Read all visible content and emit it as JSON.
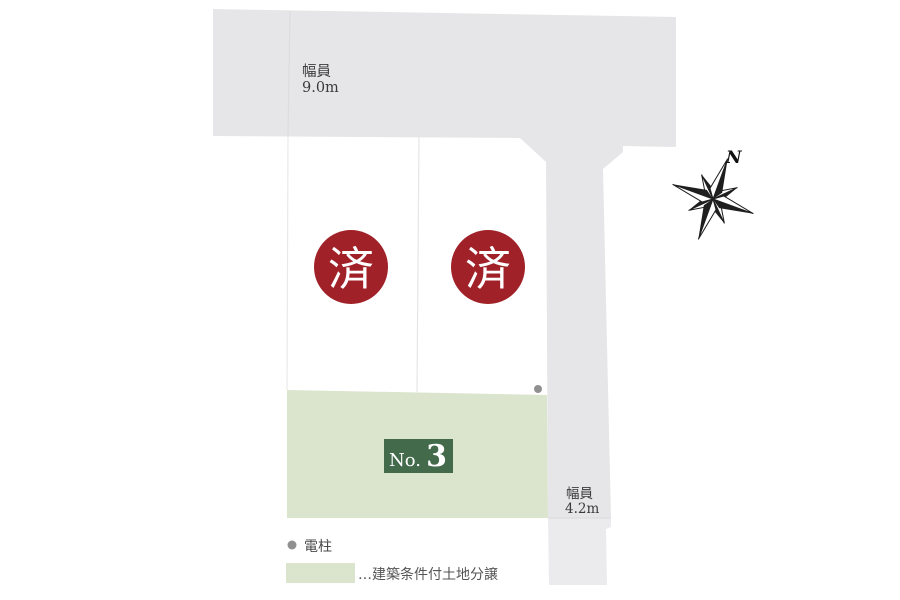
{
  "roads": {
    "fill": "#e6e6e8",
    "lower_fill": "#ebebed",
    "top_label_line1": "幅員",
    "top_label_line2": "9.0m",
    "right_label_line1": "幅員",
    "right_label_line2": "4.2m"
  },
  "lots": {
    "sold_mark": "済",
    "sold_color": "#a02127",
    "green_fill": "#dbe4cd",
    "badge_fill": "#426a4b",
    "no3_prefix": "No.",
    "no3_number": "3"
  },
  "compass": {
    "north": "N"
  },
  "symbols": {
    "pole_color": "#909091"
  },
  "legend": {
    "pole_label": "電柱",
    "green_label": "…建築条件付土地分譲"
  }
}
